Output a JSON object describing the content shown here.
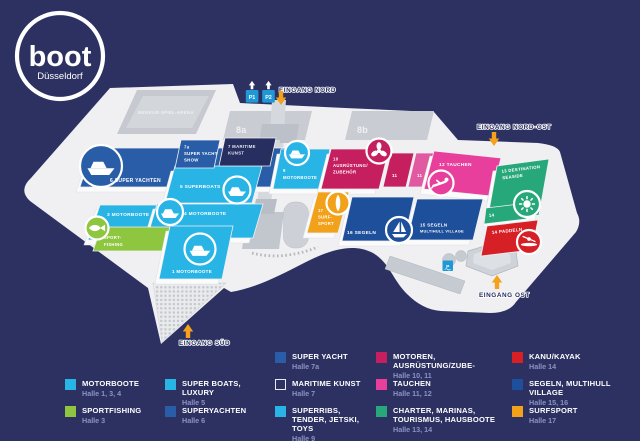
{
  "logo": {
    "brand": "boot",
    "city": "Düsseldorf"
  },
  "colors": {
    "background": "#2d3161",
    "map": "#f0f0f2",
    "building_gray": "#c7cad1",
    "cyan": "#29b4e6",
    "blue": "#2a5da8",
    "dark_navy_hall": "#272e60",
    "sail_blue": "#1d4f9a",
    "magenta": "#c51f60",
    "pink_light": "#e159a1",
    "pink": "#e73f9b",
    "teal": "#27a87b",
    "red": "#d71f26",
    "orange": "#f2a21a",
    "green": "#8ec63f",
    "parking_blue": "#1f99d6",
    "arrow_orange": "#f5a11c",
    "legend_halle_text": "#8b93c4"
  },
  "icons": {
    "hall6": "yacht-icon",
    "hall5": "motorboat-icon",
    "hall4": "motorboat-icon",
    "hall1": "motorboat-icon",
    "hall9": "motorboat-icon",
    "hall3": "fish-icon",
    "hall10": "propeller-icon",
    "hall12": "diver-icon",
    "hall13": "sun-icon",
    "hall14": "kayak-icon",
    "hall16": "sailboat-icon",
    "hall17": "surfboard-icon",
    "entrances": "entrance-arrow-icon",
    "parking": "parking-icon"
  },
  "map": {
    "arena": "MERKUR-SPIEL-ARENA",
    "hall8a": "8a",
    "hall8b": "8b",
    "parking": {
      "p1": "P1",
      "p2": "P2",
      "east": "P"
    },
    "entrances": {
      "nord": "EINGANG NORD",
      "nordost": "EINGANG NORD-OST",
      "ost": "EINGANG OST",
      "sued": "EINGANG SÜD"
    },
    "halls": {
      "h1": {
        "lines": [
          "1 MOTORBOOTE"
        ]
      },
      "h3": {
        "lines": [
          "3 MOTORBOOTE"
        ]
      },
      "sportfishing": {
        "lines": [
          "SPORT-",
          "FISHING"
        ]
      },
      "h4": {
        "lines": [
          "4 MOTORBOOTE"
        ]
      },
      "h5": {
        "lines": [
          "5 SUPERBOATS"
        ]
      },
      "h6": {
        "lines": [
          "6 SUPER YACHTEN"
        ]
      },
      "h7a": {
        "lines": [
          "7a",
          "SUPER YACHT",
          "SHOW"
        ]
      },
      "h7": {
        "lines": [
          "7 MARITIME",
          "KUNST"
        ]
      },
      "h9": {
        "lines": [
          "9",
          "MOTORBOOTE"
        ]
      },
      "h10": {
        "lines": [
          "10",
          "AUSRÜSTUNG/",
          "ZUBEHÖR"
        ]
      },
      "h11a": {
        "lines": [
          "11"
        ]
      },
      "h11b": {
        "lines": [
          "11"
        ]
      },
      "h12": {
        "lines": [
          "12 TAUCHEN"
        ]
      },
      "h13": {
        "lines": [
          "13 DESTINATION",
          "SEASIDE"
        ]
      },
      "h14": {
        "lines": [
          "14"
        ]
      },
      "h14p": {
        "lines": [
          "14 PADDELN"
        ]
      },
      "h15": {
        "lines": [
          "15 SEGELN",
          "MULTIHULL VILLAGE"
        ]
      },
      "h16": {
        "lines": [
          "16 SEGELN"
        ]
      },
      "h17": {
        "lines": [
          "17",
          "SURF-",
          "SPORT"
        ]
      }
    }
  },
  "legend": {
    "items": [
      {
        "label": "MOTORBOOTE",
        "halle": "Halle 1, 3, 4",
        "color": "#29b4e6"
      },
      {
        "label": "SPORTFISHING",
        "halle": "Halle 3",
        "color": "#8ec63f"
      },
      {
        "label": "SUPER BOATS, LUXURY",
        "halle": "Halle 5",
        "color": "#29b4e6"
      },
      {
        "label": "SUPERYACHTEN",
        "halle": "Halle 6",
        "color": "#2a5da8"
      },
      {
        "label": "SUPER YACHT",
        "halle": "Halle 7a",
        "color": "#2a5da8"
      },
      {
        "label": "MARITIME KUNST",
        "halle": "Halle 7",
        "color": "#2d3161"
      },
      {
        "label": "SUPERRIBS, TENDER, JETSKI, TOYS",
        "halle": "Halle 9",
        "color": "#29b4e6"
      },
      {
        "label": "MOTOREN, AUSRÜSTUNG/ZUBE-",
        "halle": "Halle 10, 11",
        "color": "#c51f60"
      },
      {
        "label": "TAUCHEN",
        "halle": "Halle 11, 12",
        "color": "#e73f9b"
      },
      {
        "label": "CHARTER, MARINAS, TOURISMUS, HAUSBOOTE",
        "halle": "Halle 13, 14",
        "color": "#27a87b"
      },
      {
        "label": "KANU/KAYAK",
        "halle": "Halle 14",
        "color": "#d71f26"
      },
      {
        "label": "SEGELN, MULTIHULL VILLAGE",
        "halle": "Halle 15, 16",
        "color": "#1d4f9a"
      },
      {
        "label": "SURFSPORT",
        "halle": "Halle 17",
        "color": "#f2a21a"
      }
    ]
  }
}
